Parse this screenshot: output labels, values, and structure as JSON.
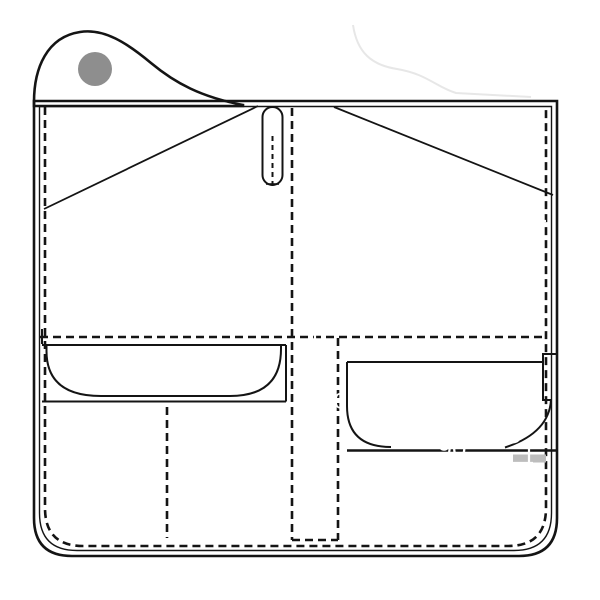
{
  "diagram": {
    "kind": "sewing-pattern-template",
    "description": "Gray pattern piece with flap, snap hole, buttonhole slot, pockets and white dimension annotations"
  },
  "colors": {
    "body-gray": "#c9c9c9",
    "flap-gray": "#a9a9a9",
    "hole-gray": "#8e8e8e",
    "line-black": "#141414",
    "dim-white": "#ffffff",
    "ghost-gray": "#e7e7e7",
    "band-gray": "#bdbdbd"
  },
  "labels": [
    {
      "name": "dim-115",
      "text": "115"
    },
    {
      "name": "dim-120",
      "text": "120"
    },
    {
      "name": "dim-65-right-upper",
      "text": "65"
    },
    {
      "name": "dim-10-circled",
      "text": "10"
    },
    {
      "name": "dim-10",
      "text": "10"
    },
    {
      "name": "dim-65-left",
      "text": "65"
    },
    {
      "name": "dim-65-middle",
      "text": "65"
    },
    {
      "name": "dim-50",
      "text": "50"
    },
    {
      "name": "dim-65-lower-middle",
      "text": "65"
    },
    {
      "name": "dim-70",
      "text": "70"
    },
    {
      "name": "dim-90",
      "text": "90"
    },
    {
      "name": "dim-30",
      "text": "30"
    },
    {
      "name": "dim-42",
      "text": "42"
    },
    {
      "name": "dim-35",
      "text": "35"
    }
  ]
}
